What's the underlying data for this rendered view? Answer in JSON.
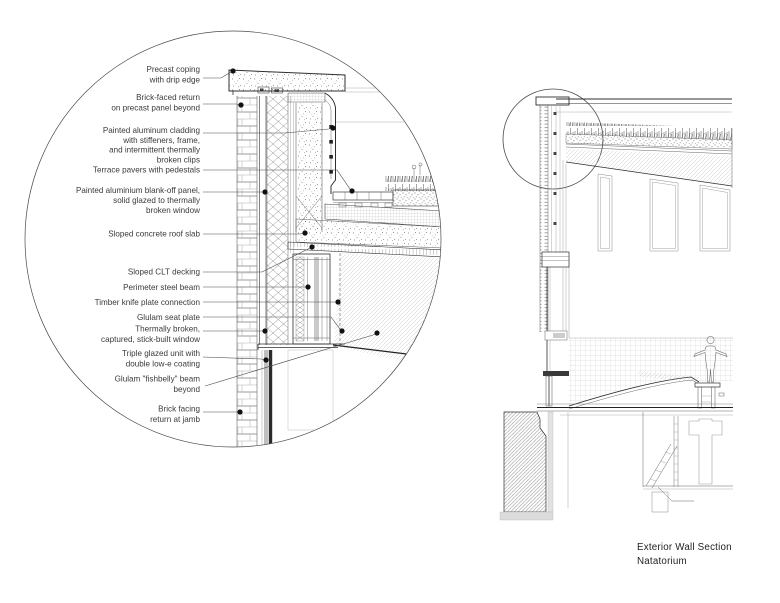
{
  "caption": [
    "Exterior Wall Section",
    "Natatorium"
  ],
  "colors": {
    "ink": "#2f2f2f",
    "light_line": "#9a9a9a",
    "label_text": "#3a3a3a",
    "background": "#ffffff",
    "leader_dot": "#111111"
  },
  "detail_callout": {
    "annotations": [
      {
        "lines": [
          "Precast coping",
          "with drip edge"
        ],
        "text_x": 200,
        "baselines": [
          72,
          82.5
        ],
        "leader": [
          [
            203,
            78
          ],
          [
            221,
            78
          ],
          [
            231,
            72
          ]
        ],
        "dot": [
          233,
          71
        ]
      },
      {
        "lines": [
          "Brick-faced return",
          "on precast panel beyond"
        ],
        "text_x": 200,
        "baselines": [
          100,
          110.5
        ],
        "leader": [
          [
            203,
            104
          ],
          [
            237,
            104
          ]
        ],
        "dot": [
          241,
          105
        ]
      },
      {
        "lines": [
          "Painted aluminum cladding",
          "with stiffeners, frame,",
          "and intermittent thermally",
          "broken clips"
        ],
        "text_x": 200,
        "baselines": [
          133,
          143,
          152.7,
          162.4
        ],
        "leader": [
          [
            203,
            133
          ],
          [
            285,
            133
          ],
          [
            329,
            129
          ]
        ],
        "dot": [
          333,
          128
        ]
      },
      {
        "lines": [
          "Terrace pavers with pedestals"
        ],
        "text_x": 200,
        "baselines": [
          172.7
        ],
        "leader": [
          [
            203,
            170
          ],
          [
            337,
            170
          ],
          [
            350,
            189
          ]
        ],
        "dot": [
          352,
          191
        ]
      },
      {
        "lines": [
          "Painted aluminium blank-off panel,",
          "solid glazed to thermally",
          "broken window"
        ],
        "text_x": 200,
        "baselines": [
          193,
          203,
          213
        ],
        "leader": [
          [
            203,
            192
          ],
          [
            261,
            192
          ]
        ],
        "dot": [
          265,
          192
        ]
      },
      {
        "lines": [
          "Sloped concrete roof slab"
        ],
        "text_x": 200,
        "baselines": [
          236.7
        ],
        "leader": [
          [
            203,
            234
          ],
          [
            300,
            234
          ]
        ],
        "dot": [
          305,
          233
        ]
      },
      {
        "lines": [
          "Sloped CLT decking"
        ],
        "text_x": 200,
        "baselines": [
          274.7
        ],
        "leader": [
          [
            203,
            272
          ],
          [
            262,
            272
          ],
          [
            308,
            249
          ]
        ],
        "dot": [
          312,
          247
        ]
      },
      {
        "lines": [
          "Perimeter steel beam"
        ],
        "text_x": 200,
        "baselines": [
          290
        ],
        "leader": [
          [
            203,
            287
          ],
          [
            303,
            287
          ]
        ],
        "dot": [
          308,
          287
        ]
      },
      {
        "lines": [
          "Timber knife plate connection"
        ],
        "text_x": 200,
        "baselines": [
          305
        ],
        "leader": [
          [
            203,
            302
          ],
          [
            333,
            302
          ]
        ],
        "dot": [
          338,
          302
        ]
      },
      {
        "lines": [
          "Glulam seat plate"
        ],
        "text_x": 200,
        "baselines": [
          320
        ],
        "leader": [
          [
            203,
            317
          ],
          [
            331,
            317
          ],
          [
            340,
            329
          ]
        ],
        "dot": [
          342,
          331
        ]
      },
      {
        "lines": [
          "Thermally broken,",
          "captured, stick-built window"
        ],
        "text_x": 200,
        "baselines": [
          331.7,
          342.2
        ],
        "leader": [
          [
            203,
            331
          ],
          [
            260,
            331
          ]
        ],
        "dot": [
          265,
          331
        ]
      },
      {
        "lines": [
          "Triple glazed unit with",
          "double low-e coating"
        ],
        "text_x": 200,
        "baselines": [
          356,
          366.5
        ],
        "leader": [
          [
            203,
            357
          ],
          [
            261,
            359
          ]
        ],
        "dot": [
          266,
          360
        ]
      },
      {
        "lines": [
          "Glulam \"fishbelly\" beam",
          "beyond"
        ],
        "text_x": 200,
        "baselines": [
          381.7,
          392.2
        ],
        "leader": [
          [
            205,
            386
          ],
          [
            373,
            335
          ]
        ],
        "dot": [
          377,
          333
        ]
      },
      {
        "lines": [
          "Brick facing",
          "return at jamb"
        ],
        "text_x": 200,
        "baselines": [
          411.7,
          422.2
        ],
        "leader": [
          [
            203,
            412
          ],
          [
            235,
            412
          ]
        ],
        "dot": [
          240,
          412
        ]
      }
    ]
  }
}
